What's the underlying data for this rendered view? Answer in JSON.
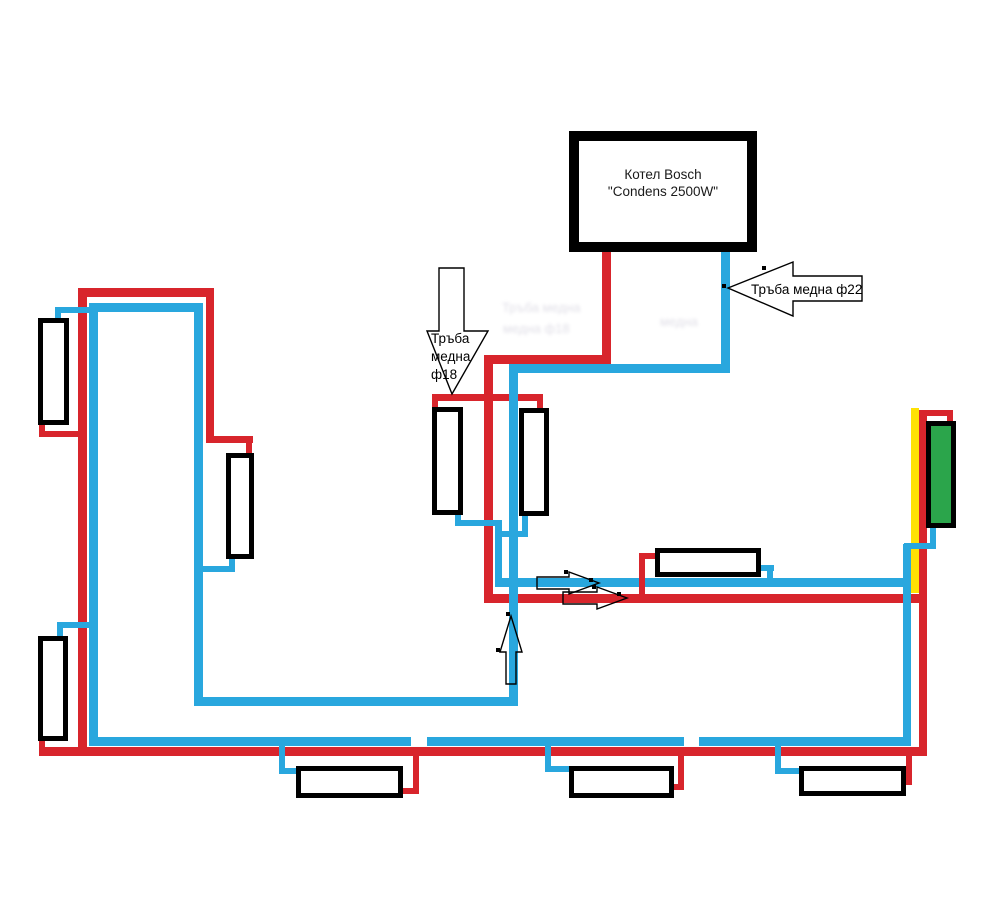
{
  "diagram": {
    "canvas": {
      "w": 998,
      "h": 920,
      "bg": "#ffffff"
    },
    "colors": {
      "supply_red": "#d8252c",
      "return_blue": "#29a7de",
      "marker_yellow": "#ffe204",
      "radiator_green": "#2ba54b",
      "outline_black": "#000000"
    },
    "boiler": {
      "label_line1": "Котел Bosch",
      "label_line2": "\"Condens 2500W\""
    },
    "labels": {
      "pipe22": {
        "text": "Тръба медна ф22"
      },
      "pipe18": {
        "lines": [
          "Тръба",
          "медна",
          "ф18"
        ]
      }
    },
    "ghost_text": [
      {
        "text": "Тръба медна",
        "x": 502,
        "y": 300
      },
      {
        "text": "медна ф18",
        "x": 503,
        "y": 321
      },
      {
        "text": "медна",
        "x": 660,
        "y": 314
      }
    ],
    "pipes": {
      "marker": [
        [
          911,
          408,
          8,
          185
        ]
      ],
      "supply": [
        [
          602,
          248,
          9,
          116
        ],
        [
          484,
          355,
          127,
          9
        ],
        [
          484,
          355,
          9,
          248
        ],
        [
          432,
          394,
          111,
          7
        ],
        [
          432,
          394,
          6,
          16
        ],
        [
          537,
          394,
          6,
          17
        ],
        [
          484,
          594,
          443,
          9
        ],
        [
          919,
          410,
          8,
          346
        ],
        [
          919,
          410,
          34,
          6
        ],
        [
          947,
          410,
          6,
          15
        ],
        [
          39,
          747,
          888,
          9
        ],
        [
          906,
          751,
          6,
          34
        ],
        [
          899,
          779,
          10,
          6
        ],
        [
          413,
          752,
          6,
          42
        ],
        [
          399,
          788,
          16,
          6
        ],
        [
          678,
          752,
          6,
          38
        ],
        [
          670,
          784,
          10,
          6
        ],
        [
          78,
          288,
          9,
          468
        ],
        [
          78,
          288,
          136,
          9
        ],
        [
          206,
          288,
          8,
          155
        ],
        [
          206,
          436,
          47,
          7
        ],
        [
          246,
          436,
          6,
          20
        ],
        [
          39,
          424,
          6,
          12
        ],
        [
          39,
          431,
          45,
          6
        ],
        [
          39,
          739,
          6,
          10
        ]
      ],
      "return": [
        [
          721,
          248,
          9,
          125
        ],
        [
          509,
          364,
          221,
          9
        ],
        [
          509,
          364,
          9,
          342
        ],
        [
          194,
          697,
          324,
          9
        ],
        [
          194,
          303,
          9,
          403
        ],
        [
          89,
          303,
          114,
          9
        ],
        [
          89,
          303,
          9,
          443
        ],
        [
          89,
          737,
          822,
          9
        ],
        [
          903,
          544,
          8,
          202
        ],
        [
          495,
          578,
          416,
          9
        ],
        [
          495,
          520,
          7,
          67
        ],
        [
          455,
          512,
          6,
          14
        ],
        [
          455,
          520,
          47,
          6
        ],
        [
          522,
          513,
          6,
          24
        ],
        [
          497,
          531,
          31,
          6
        ],
        [
          55,
          307,
          6,
          13
        ],
        [
          55,
          307,
          43,
          6
        ],
        [
          57,
          622,
          6,
          16
        ],
        [
          57,
          622,
          41,
          6
        ],
        [
          229,
          556,
          6,
          16
        ],
        [
          198,
          566,
          37,
          6
        ],
        [
          759,
          565,
          15,
          6
        ],
        [
          767,
          565,
          6,
          20
        ],
        [
          279,
          742,
          6,
          32
        ],
        [
          279,
          768,
          20,
          6
        ],
        [
          545,
          742,
          6,
          30
        ],
        [
          545,
          766,
          26,
          6
        ],
        [
          775,
          742,
          6,
          32
        ],
        [
          775,
          768,
          26,
          6
        ],
        [
          930,
          527,
          6,
          22
        ],
        [
          904,
          543,
          32,
          6
        ]
      ],
      "gaps": [
        [
          411,
          737,
          16,
          9
        ],
        [
          684,
          737,
          15,
          9
        ]
      ],
      "supply_top": [
        [
          639,
          553,
          6,
          46
        ],
        [
          639,
          553,
          17,
          6
        ]
      ]
    },
    "radiators": [
      {
        "name": "radiator-left-upper",
        "x": 38,
        "y": 318,
        "w": 31,
        "h": 107,
        "fill": "white"
      },
      {
        "name": "radiator-inner-wall",
        "x": 226,
        "y": 453,
        "w": 28,
        "h": 106,
        "fill": "white"
      },
      {
        "name": "radiator-left-lower",
        "x": 38,
        "y": 636,
        "w": 30,
        "h": 105,
        "fill": "white"
      },
      {
        "name": "radiator-middle-left",
        "x": 432,
        "y": 407,
        "w": 31,
        "h": 108,
        "fill": "white"
      },
      {
        "name": "radiator-middle-right",
        "x": 519,
        "y": 408,
        "w": 30,
        "h": 108,
        "fill": "white"
      },
      {
        "name": "radiator-right-horizontal",
        "x": 655,
        "y": 548,
        "w": 106,
        "h": 29,
        "fill": "white"
      },
      {
        "name": "radiator-bottom-left",
        "x": 296,
        "y": 766,
        "w": 107,
        "h": 32,
        "fill": "white"
      },
      {
        "name": "radiator-bottom-middle",
        "x": 569,
        "y": 766,
        "w": 105,
        "h": 32,
        "fill": "white"
      },
      {
        "name": "radiator-bottom-right",
        "x": 799,
        "y": 766,
        "w": 107,
        "h": 30,
        "fill": "white"
      },
      {
        "name": "radiator-green",
        "x": 926,
        "y": 421,
        "w": 30,
        "h": 107,
        "fill": "green"
      }
    ],
    "arrows": [
      {
        "name": "pipe22-callout-arrow",
        "fill": "#ffffff",
        "points": "728,288 793,262 793,276 862,276 862,301 793,301 793,316"
      },
      {
        "name": "pipe18-callout-arrow",
        "fill": "#ffffff",
        "points": "439,268 464,268 464,331 488,331 452,394 427,331 439,331"
      },
      {
        "name": "flow-up-arrow",
        "fill": "none",
        "points": "511,616 522,652 516,652 516,684 506,684 506,652 500,652"
      },
      {
        "name": "flow-right-arrow-blue",
        "fill": "none",
        "points": "537,577 569,577 569,572 599,583 569,594 569,589 537,589"
      },
      {
        "name": "flow-right-arrow-red",
        "fill": "none",
        "points": "563,592 597,592 597,587 627,598 597,609 597,604 563,604"
      }
    ],
    "arrow_dots": [
      [
        724,
        286
      ],
      [
        764,
        268
      ],
      [
        591,
        580
      ],
      [
        566,
        572
      ],
      [
        619,
        594
      ],
      [
        594,
        587
      ],
      [
        508,
        614
      ],
      [
        498,
        650
      ]
    ]
  }
}
